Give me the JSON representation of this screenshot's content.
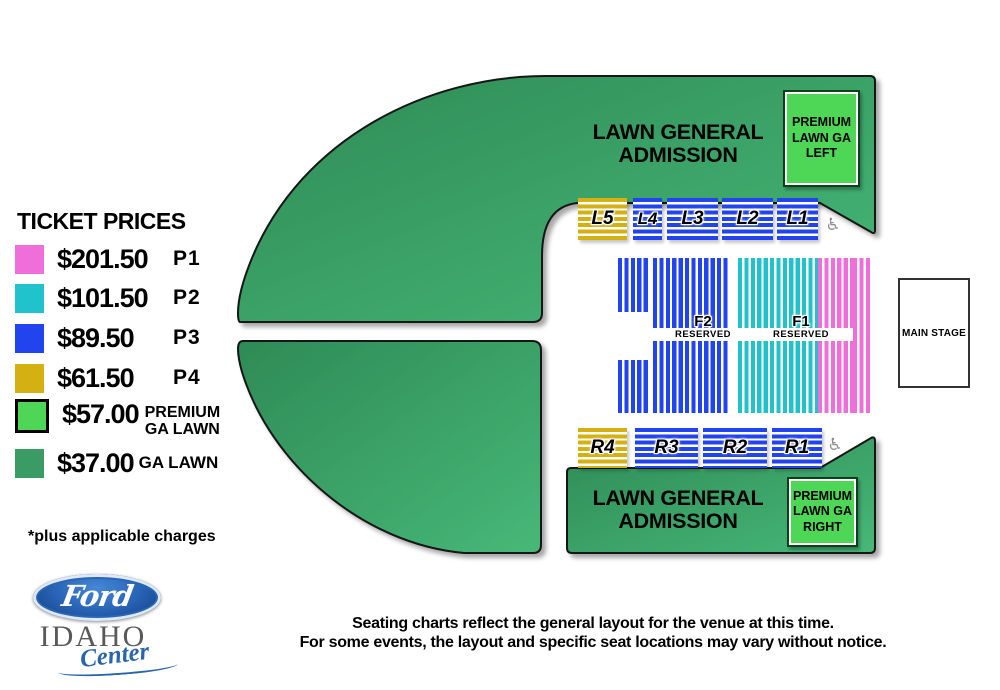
{
  "legend": {
    "title": "TICKET PRICES",
    "items": [
      {
        "price": "$201.50",
        "tier": "P1",
        "color": "#EF6ED9"
      },
      {
        "price": "$101.50",
        "tier": "P2",
        "color": "#20C3CB"
      },
      {
        "price": "$89.50",
        "tier": "P3",
        "color": "#2244EE"
      },
      {
        "price": "$61.50",
        "tier": "P4",
        "color": "#D4B012"
      },
      {
        "price": "$57.00",
        "tier_line1": "PREMIUM",
        "tier_line2": "GA LAWN",
        "color": "#4ED656"
      },
      {
        "price": "$37.00",
        "tier": "GA LAWN",
        "color": "#3A9B64"
      }
    ],
    "footnote": "*plus applicable charges"
  },
  "venue_logo": {
    "brand": "Ford",
    "name_line1": "IDAHO",
    "name_line2": "Center"
  },
  "map": {
    "lawn_top": {
      "line1": "LAWN GENERAL",
      "line2": "ADMISSION"
    },
    "lawn_bottom": {
      "line1": "LAWN GENERAL",
      "line2": "ADMISSION"
    },
    "premium_left": {
      "line1": "PREMIUM",
      "line2": "LAWN GA",
      "line3": "LEFT"
    },
    "premium_right": {
      "line1": "PREMIUM",
      "line2": "LAWN GA",
      "line3": "RIGHT"
    },
    "stage": {
      "label": "MAIN STAGE"
    },
    "sections_top": [
      {
        "label": "L5"
      },
      {
        "label": "L4"
      },
      {
        "label": "L3"
      },
      {
        "label": "L2"
      },
      {
        "label": "L1"
      }
    ],
    "sections_bottom": [
      {
        "label": "R4"
      },
      {
        "label": "R3"
      },
      {
        "label": "R2"
      },
      {
        "label": "R1"
      }
    ],
    "floor": {
      "f2": {
        "label": "F2",
        "sub": "RESERVED"
      },
      "f1": {
        "label": "F1",
        "sub": "RESERVED"
      }
    },
    "accessible_icon": "♿",
    "colors": {
      "lawn_dark_1": "#2E8B55",
      "lawn_dark_2": "#47B878",
      "premium_green": "#4ED656"
    }
  },
  "disclaimer": {
    "line1": "Seating charts reflect the general layout for the venue at this time.",
    "line2": "For some events, the layout and specific seat locations may vary without notice."
  }
}
